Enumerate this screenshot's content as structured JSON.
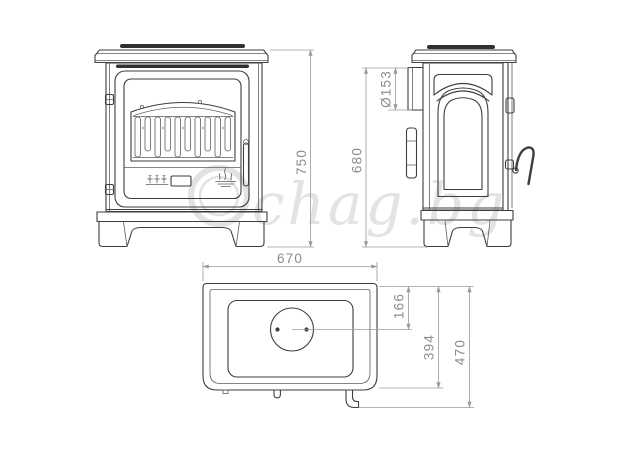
{
  "drawing": {
    "dimensions": {
      "front_height": "750",
      "side_height": "680",
      "flue_diameter": "Ø153",
      "top_width": "670",
      "flue_center_from_front": "166",
      "plate_depth": "394",
      "overall_depth": "470"
    },
    "watermark": {
      "text": "chag.bg",
      "icon": "ring-logo-icon",
      "color": "#e3e3e3"
    },
    "icons": {
      "flame_logo": "flame-icon",
      "air_controls": "air-control-levers-icon"
    },
    "colors": {
      "background": "#ffffff",
      "object_line": "#3e3e3e",
      "dimension_line": "#9a9a9a",
      "dimension_text": "#8c8c8c",
      "vent_slot": "#303030"
    }
  }
}
